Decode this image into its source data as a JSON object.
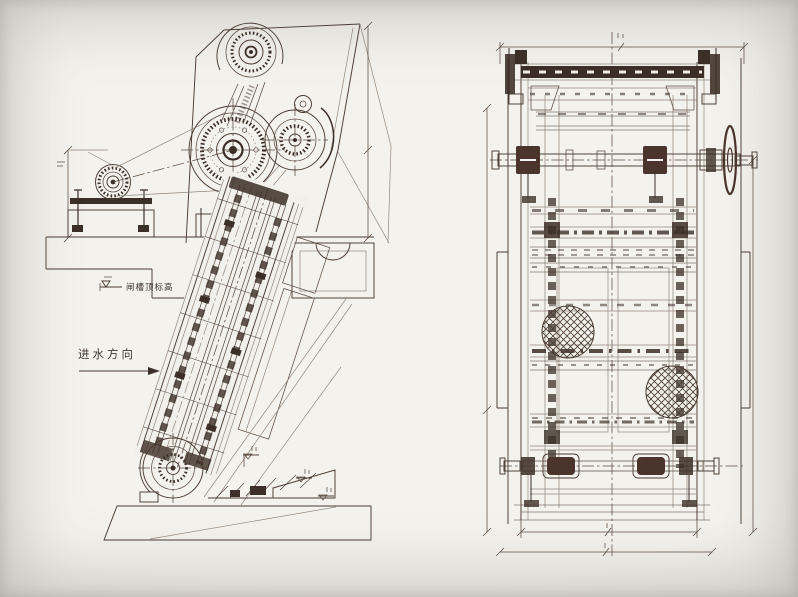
{
  "colors": {
    "paper": "#f2f0ea",
    "ink": "#4a3c32",
    "ink_faded": "#93897d",
    "ink_dark": "#3b2f27",
    "ink_maroon": "#4a342c"
  },
  "labels": {
    "flow_direction": "进水方向",
    "top_elevation": "闸槽顶标高"
  },
  "symbols": {
    "elevation_marker": "inverted-triangle-flag",
    "flow_arrow": "right-arrow",
    "center_line": "dash-dot-line"
  }
}
